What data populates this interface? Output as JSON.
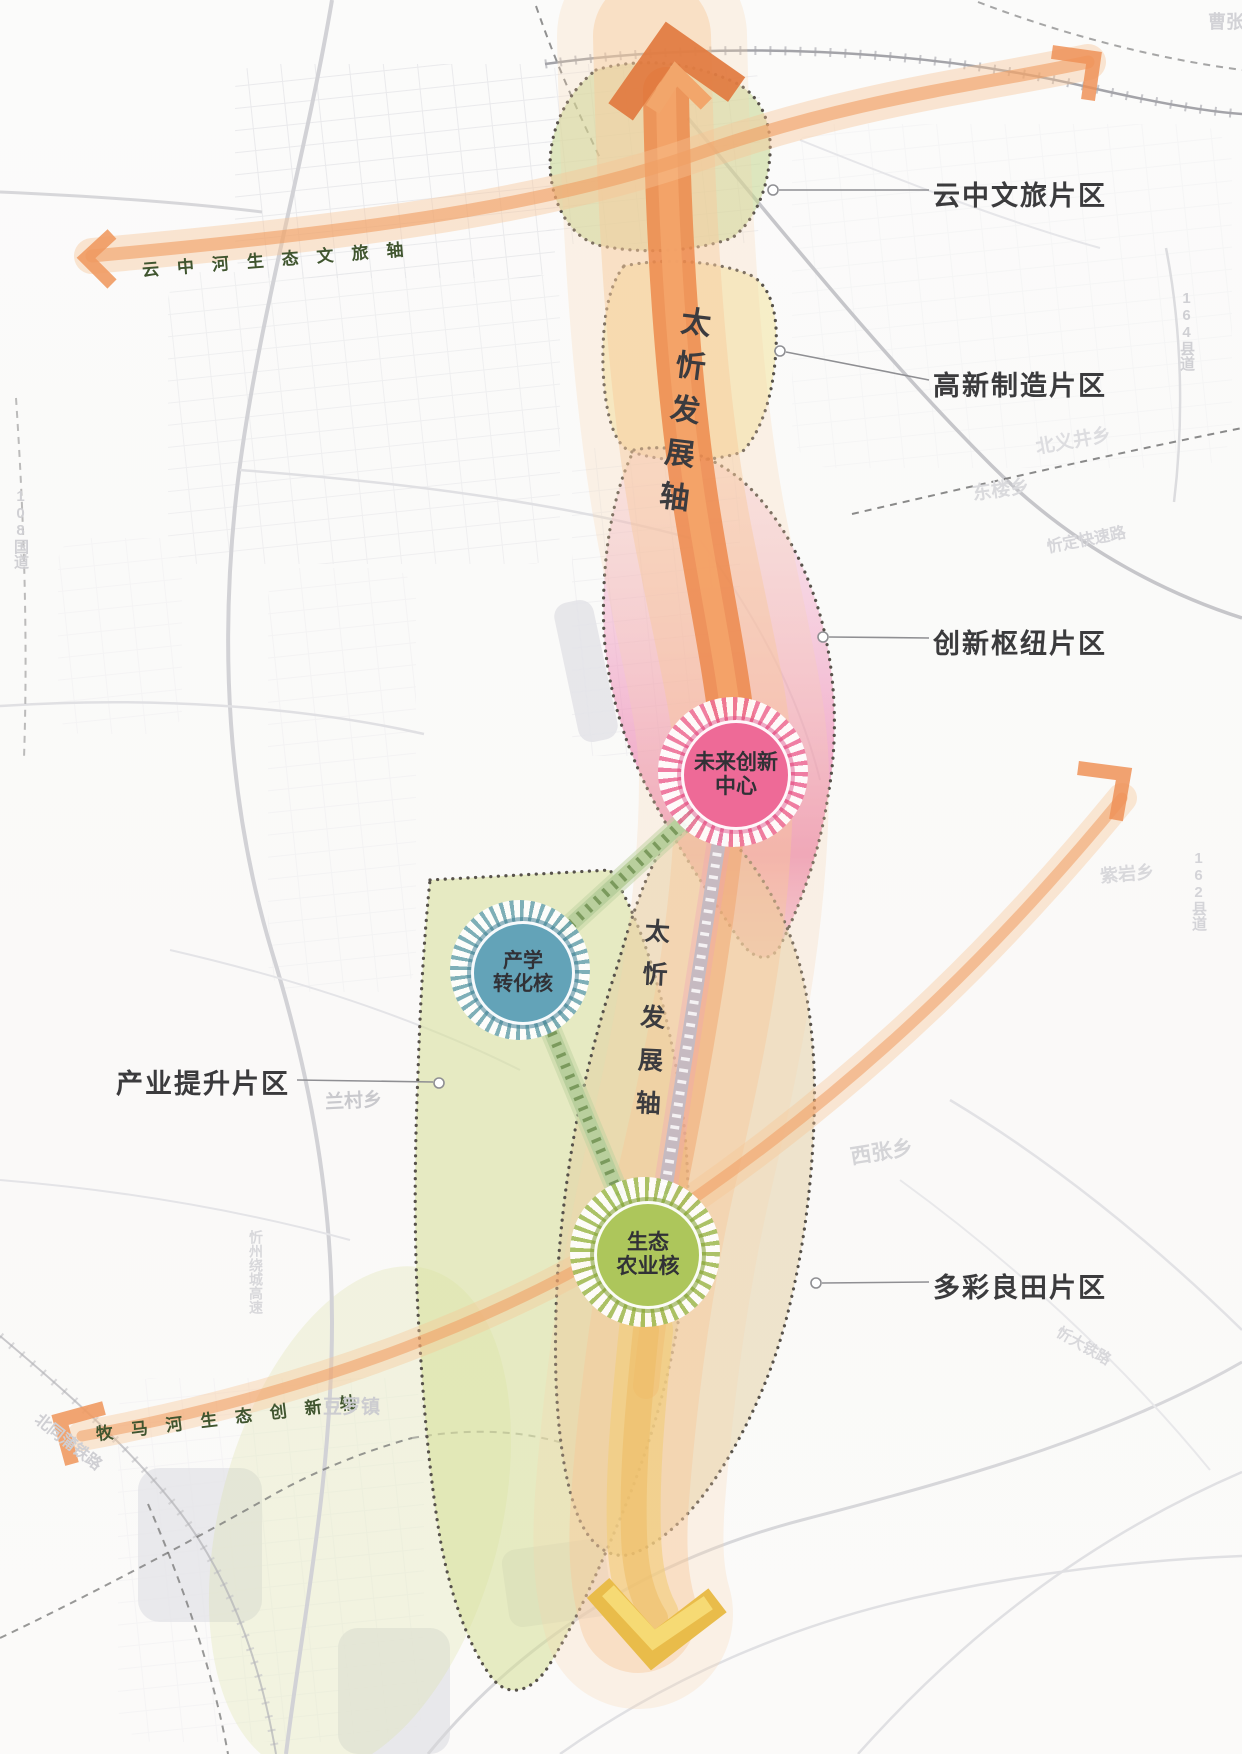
{
  "districts": [
    {
      "label": "云中文旅片区"
    },
    {
      "label": "高新制造片区"
    },
    {
      "label": "创新枢纽片区"
    },
    {
      "label": "多彩良田片区"
    },
    {
      "label": "产业提升片区"
    }
  ],
  "axes": {
    "yunzhong": "云中河生态文旅轴",
    "mumahe": "牧马河生态创新轴",
    "taixin_upper": "太忻发展轴",
    "taixin_lower": "太忻发展轴"
  },
  "cores": {
    "future": {
      "line1": "未来创新",
      "line2": "中心"
    },
    "industry_study": {
      "line1": "产学",
      "line2": "转化核"
    },
    "eco_agri": {
      "line1": "生态",
      "line2": "农业核"
    }
  },
  "places": [
    {
      "text": "兰村乡"
    },
    {
      "text": "西张乡"
    },
    {
      "text": "东楼乡"
    },
    {
      "text": "北义井乡"
    },
    {
      "text": "紫岩乡"
    },
    {
      "text": "164县道"
    },
    {
      "text": "162县道"
    },
    {
      "text": "忻定快速路"
    },
    {
      "text": "忻州绕城高速"
    },
    {
      "text": "北同蒲铁路"
    },
    {
      "text": "豆罗镇"
    },
    {
      "text": "108国道"
    },
    {
      "text": "曹张乡"
    },
    {
      "text": "忻大铁路"
    }
  ],
  "colors": {
    "axis_orange": "#ec844a",
    "band_halo": "#f7c798",
    "region_green": "#cdda93",
    "region_yellow": "#f0e29a",
    "region_pink": "#e87fae",
    "region_olive": "#d6de96",
    "region_tan": "#e2cea0",
    "core_pink": "#ee6a97",
    "core_blue": "#63a3b8",
    "core_green": "#adc65b",
    "yellow_arrow": "#f0c14b",
    "label_dark": "#3b3b3d",
    "axis_text_green": "#40552f"
  }
}
